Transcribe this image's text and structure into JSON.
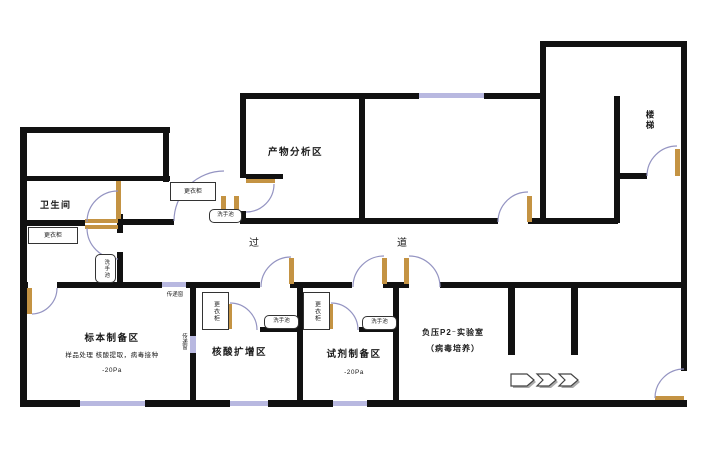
{
  "colors": {
    "wall": "#111111",
    "door_leaf": "#c49343",
    "window": "#b8b8e0",
    "door_arc": "#9494c2",
    "text": "#1a1a1a"
  },
  "rooms": {
    "toilet": {
      "label": "卫生间"
    },
    "product_analysis": {
      "label": "产物分析区"
    },
    "stairwell": {
      "label": "楼梯"
    },
    "corridor": {
      "char_left": "过",
      "char_right": "道"
    },
    "specimen_prep": {
      "label": "标本制备区",
      "sublabel": "样品处理 核酸提取，病毒接种",
      "pressure": "-20Pa"
    },
    "nucleic_acid_amplification": {
      "label": "核酸扩增区"
    },
    "reagent_prep": {
      "label": "试剂制备区",
      "pressure": "-20Pa"
    },
    "p2_lab": {
      "label_line1": "负压P2⁻实验室",
      "label_line2": "（病毒培养）"
    }
  },
  "fixtures": {
    "wardrobe_label": "更衣柜",
    "sink_label": "洗手池",
    "pass_window_label": "传递窗"
  }
}
